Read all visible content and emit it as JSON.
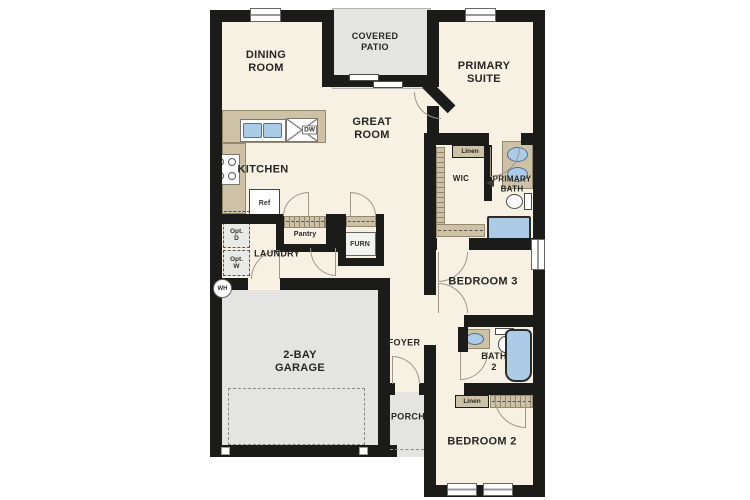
{
  "rooms": {
    "dining": "DINING\nROOM",
    "covered_patio": "COVERED\nPATIO",
    "primary_suite": "PRIMARY\nSUITE",
    "kitchen": "KITCHEN",
    "great_room": "GREAT\nROOM",
    "wic": "WIC",
    "primary_bath": "PRIMARY\nBATH",
    "laundry": "LAUNDRY",
    "bedroom3": "BEDROOM 3",
    "garage": "2-BAY\nGARAGE",
    "foyer": "FOYER",
    "porch": "PORCH",
    "bath2": "BATH\n2",
    "bedroom2": "BEDROOM 2"
  },
  "fixtures": {
    "dishwasher": "DW",
    "refrigerator": "Ref",
    "pantry": "Pantry",
    "furnace": "FURN",
    "water_heater": "WH",
    "opt_dryer": "Opt.\nD",
    "opt_washer": "Opt.\nW",
    "linen_top": "Linen",
    "linen_bottom": "Linen"
  },
  "colors": {
    "wall": "#1b1b19",
    "floor": "#f7f1e3",
    "concrete": "#e4e4e2",
    "counter": "#cdc2a6",
    "fixture_blue": "#abcbe6"
  }
}
